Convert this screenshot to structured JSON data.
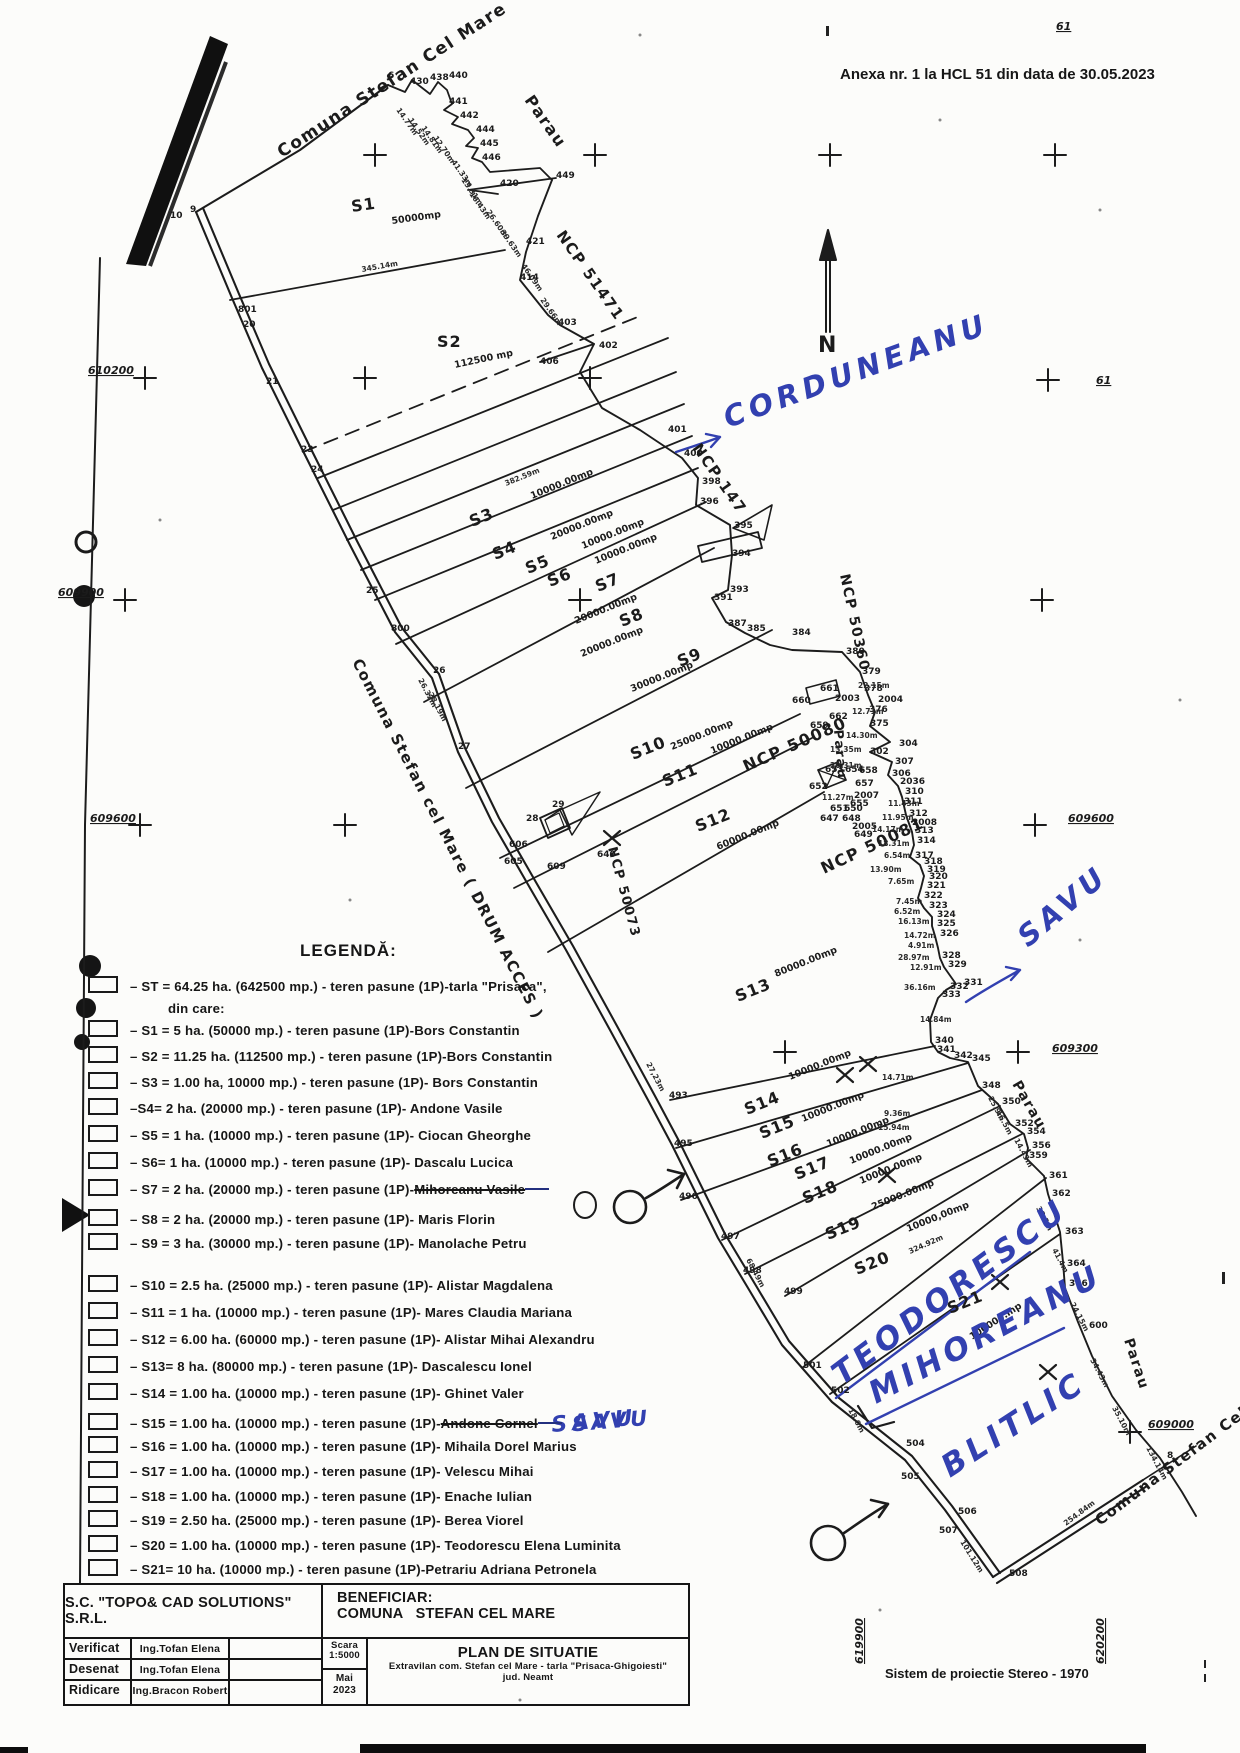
{
  "page": {
    "anexa": "Anexa nr. 1 la HCL 51 din data de 30.05.2023",
    "projection_note": "Sistem de proiectie Stereo - 1970"
  },
  "title_block": {
    "company": "S.C. \"TOPO& CAD SOLUTIONS\" S.R.L.",
    "beneficiar_label": "BENEFICIAR:",
    "beneficiar": "COMUNA   STEFAN CEL MARE",
    "rows": [
      {
        "role": "Verificat",
        "name": "Ing.Tofan Elena"
      },
      {
        "role": "Desenat",
        "name": "Ing.Tofan Elena"
      },
      {
        "role": "Ridicare",
        "name": "Ing.Bracon Robert"
      }
    ],
    "scara_label": "Scara",
    "scara": "1:5000",
    "month": "Mai",
    "year": "2023",
    "plan_title": "PLAN DE SITUATIE",
    "plan_subtitle": "Extravilan com. Stefan cel Mare - tarla \"Prisaca-Ghigoiesti\"",
    "plan_sub2": "jud. Neamt"
  },
  "legend": {
    "title": "LEGENDĂ:",
    "items": [
      {
        "text": "– ST = 64.25 ha. (642500 mp.) - teren pasune (1P)-tarla \"Prisaca\","
      },
      {
        "text": "din care:",
        "cont": true
      },
      {
        "text": "– S1 = 5 ha. (50000 mp.) - teren pasune (1P)-Bors Constantin"
      },
      {
        "text": "– S2 = 11.25 ha. (112500 mp.) - teren pasune (1P)-Bors Constantin"
      },
      {
        "text": "– S3 = 1.00 ha, 10000 mp.) - teren pasune (1P)- Bors Constantin"
      },
      {
        "text": "–S4= 2 ha. (20000 mp.) - teren pasune (1P)- Andone Vasile"
      },
      {
        "text": "– S5 = 1 ha. (10000 mp.) - teren pasune (1P)- Ciocan Gheorghe"
      },
      {
        "text": "– S6= 1 ha. (10000 mp.) - teren pasune (1P)- Dascalu Lucica"
      },
      {
        "text": "– S7 = 2 ha. (20000 mp.) - teren pasune (1P)-",
        "struck": "Mihoreanu Vasile"
      },
      {
        "text": "– S8 = 2 ha. (20000 mp.) - teren pasune (1P)- Maris Florin"
      },
      {
        "text": "– S9 = 3 ha. (30000 mp.) - teren pasune (1P)- Manolache Petru"
      },
      {
        "text": "– S10 = 2.5 ha. (25000 mp.) - teren pasune (1P)- Alistar Magdalena"
      },
      {
        "text": "– S11 = 1 ha. (10000 mp.) - teren pasune (1P)- Mares Claudia Mariana"
      },
      {
        "text": "– S12 = 6.00 ha. (60000 mp.) - teren pasune (1P)- Alistar Mihai Alexandru"
      },
      {
        "text": "– S13= 8 ha. (80000 mp.) - teren pasune (1P)- Dascalescu Ionel"
      },
      {
        "text": "– S14 = 1.00 ha. (10000 mp.) - teren pasune (1P)- Ghinet Valer"
      },
      {
        "text": "– S15 = 1.00 ha. (10000 mp.) - teren pasune (1P)-",
        "struck": "Andone Cornel",
        "note": "SAVU"
      },
      {
        "text": "– S16 = 1.00 ha. (10000 mp.) - teren pasune (1P)- Mihaila Dorel Marius"
      },
      {
        "text": "– S17 = 1.00 ha. (10000 mp.) - teren pasune (1P)- Velescu Mihai"
      },
      {
        "text": "– S18 = 1.00 ha. (10000 mp.) - teren pasune (1P)- Enache Iulian"
      },
      {
        "text": "– S19 = 2.50 ha. (25000 mp.) - teren pasune (1P)- Berea Viorel"
      },
      {
        "text": "– S20 = 1.00 ha. (10000 mp.) - teren pasune (1P)- Teodorescu Elena Luminita"
      },
      {
        "text": "– S21= 10 ha. (10000 mp.) - teren pasune (1P)-Petrariu Adriana Petronela"
      }
    ]
  },
  "map": {
    "labels": {
      "comuna_top": "Comuna Stefan Cel Mare",
      "parau_top": "Parau",
      "ncp51471": "NCP 51471",
      "ncp147": "NCP 147",
      "ncp50360": "NCP 50360",
      "ncp50080": "NCP 50080",
      "ncp50081": "NCP 50081",
      "ncp50073": "NCP 50073",
      "parau_mid": "Parau",
      "parau_s14": "Parau",
      "parau_low": "Parau",
      "drum": "Comuna Stefan cel Mare ( DRUM ACCES )",
      "comuna_bottom": "Comuna Stefan Cel Mare",
      "north": "N"
    },
    "parcels": [
      {
        "n": "S1",
        "x": 352,
        "y": 212,
        "r": -8,
        "a": "50000mp",
        "ax": 392,
        "ay": 224,
        "ar": -8
      },
      {
        "n": "S2",
        "x": 437,
        "y": 347,
        "r": 0,
        "a": "112500 mp",
        "ax": 455,
        "ay": 368,
        "ar": -12
      },
      {
        "n": "S3",
        "x": 472,
        "y": 527,
        "r": -22,
        "a": "10000.00mp",
        "ax": 532,
        "ay": 499
      },
      {
        "n": "S4",
        "x": 495,
        "y": 560,
        "r": -22,
        "a": "20000.00mp",
        "ax": 552,
        "ay": 540
      },
      {
        "n": "S5",
        "x": 528,
        "y": 574,
        "r": -22,
        "a": "10000.00mp",
        "ax": 583,
        "ay": 549
      },
      {
        "n": "S6",
        "x": 550,
        "y": 587,
        "r": -22,
        "a": "10000.00mp",
        "ax": 596,
        "ay": 564
      },
      {
        "n": "S7",
        "x": 598,
        "y": 592,
        "r": -22,
        "a": "20000.00mp",
        "ax": 576,
        "ay": 624
      },
      {
        "n": "S8",
        "x": 622,
        "y": 627,
        "r": -22,
        "a": "20000.00mp",
        "ax": 582,
        "ay": 657
      },
      {
        "n": "S9",
        "x": 680,
        "y": 667,
        "r": -22,
        "a": "30000.00mp",
        "ax": 632,
        "ay": 692
      },
      {
        "n": "S10",
        "x": 633,
        "y": 760,
        "r": -22,
        "a": "25000.00mp",
        "ax": 672,
        "ay": 750
      },
      {
        "n": "S11",
        "x": 665,
        "y": 787,
        "r": -22,
        "a": "10000.00mp",
        "ax": 712,
        "ay": 754
      },
      {
        "n": "S12",
        "x": 698,
        "y": 832,
        "r": -22,
        "a": "60000.00mp",
        "ax": 718,
        "ay": 850
      },
      {
        "n": "S13",
        "x": 738,
        "y": 1002,
        "r": -22,
        "a": "80000.00mp",
        "ax": 776,
        "ay": 977
      },
      {
        "n": "S14",
        "x": 747,
        "y": 1115,
        "r": -22,
        "a": "10000.00mp",
        "ax": 790,
        "ay": 1080
      },
      {
        "n": "S15",
        "x": 762,
        "y": 1139,
        "r": -22,
        "a": "10000.00mp",
        "ax": 803,
        "ay": 1122
      },
      {
        "n": "S16",
        "x": 770,
        "y": 1167,
        "r": -22,
        "a": "10000.00mp",
        "ax": 828,
        "ay": 1147
      },
      {
        "n": "S17",
        "x": 797,
        "y": 1180,
        "r": -22,
        "a": "10000.00mp",
        "ax": 851,
        "ay": 1164
      },
      {
        "n": "S18",
        "x": 805,
        "y": 1204,
        "r": -22,
        "a": "10000.00mp",
        "ax": 861,
        "ay": 1184
      },
      {
        "n": "S19",
        "x": 828,
        "y": 1240,
        "r": -22,
        "a": "25000.00mp",
        "ax": 873,
        "ay": 1210
      },
      {
        "n": "S20",
        "x": 857,
        "y": 1275,
        "r": -22,
        "a": "10000,00mp",
        "ax": 908,
        "ay": 1232
      },
      {
        "n": "S21",
        "x": 950,
        "y": 1314,
        "r": -22,
        "a": "100000.mp",
        "ax": 972,
        "ay": 1340,
        "ar": -33
      }
    ],
    "point_labels": [
      [
        "6",
        388,
        78
      ],
      [
        "430",
        410,
        84
      ],
      [
        "438",
        430,
        80
      ],
      [
        "440",
        449,
        78
      ],
      [
        "441",
        449,
        104
      ],
      [
        "442",
        460,
        118
      ],
      [
        "444",
        476,
        132
      ],
      [
        "445",
        480,
        146
      ],
      [
        "446",
        482,
        160
      ],
      [
        "420",
        500,
        186
      ],
      [
        "449",
        556,
        178
      ],
      [
        "421",
        526,
        244
      ],
      [
        "414",
        520,
        280
      ],
      [
        "403",
        558,
        325
      ],
      [
        "402",
        599,
        348
      ],
      [
        "406",
        540,
        364
      ],
      [
        "401",
        668,
        432
      ],
      [
        "400",
        684,
        456
      ],
      [
        "398",
        702,
        484
      ],
      [
        "396",
        700,
        504
      ],
      [
        "395",
        734,
        528
      ],
      [
        "394",
        732,
        556
      ],
      [
        "393",
        730,
        592
      ],
      [
        "391",
        714,
        600
      ],
      [
        "387",
        728,
        626
      ],
      [
        "385",
        747,
        631
      ],
      [
        "384",
        792,
        635
      ],
      [
        "380",
        846,
        654
      ],
      [
        "379",
        862,
        674
      ],
      [
        "378",
        864,
        691
      ],
      [
        "2004",
        878,
        702
      ],
      [
        "376",
        869,
        712
      ],
      [
        "375",
        870,
        726
      ],
      [
        "304",
        899,
        746
      ],
      [
        "302",
        870,
        754
      ],
      [
        "307",
        895,
        764
      ],
      [
        "306",
        892,
        776
      ],
      [
        "661",
        820,
        691
      ],
      [
        "660",
        792,
        703
      ],
      [
        "2003",
        835,
        701
      ],
      [
        "662",
        829,
        719
      ],
      [
        "659",
        810,
        728
      ],
      [
        "653",
        825,
        772
      ],
      [
        "654",
        845,
        772
      ],
      [
        "658",
        859,
        773
      ],
      [
        "652",
        809,
        789
      ],
      [
        "657",
        855,
        786
      ],
      [
        "2007",
        854,
        798
      ],
      [
        "655",
        850,
        806
      ],
      [
        "651",
        830,
        811
      ],
      [
        "650",
        844,
        811
      ],
      [
        "647",
        820,
        821
      ],
      [
        "648",
        842,
        821
      ],
      [
        "2005",
        852,
        829
      ],
      [
        "649",
        854,
        837
      ],
      [
        "2036",
        900,
        784
      ],
      [
        "310",
        905,
        794
      ],
      [
        "311",
        904,
        804
      ],
      [
        "312",
        909,
        816
      ],
      [
        "2008",
        912,
        825
      ],
      [
        "313",
        915,
        833
      ],
      [
        "314",
        917,
        843
      ],
      [
        "317",
        915,
        858
      ],
      [
        "318",
        924,
        864
      ],
      [
        "319",
        927,
        872
      ],
      [
        "320",
        929,
        879
      ],
      [
        "321",
        927,
        888
      ],
      [
        "322",
        924,
        898
      ],
      [
        "323",
        929,
        908
      ],
      [
        "324",
        937,
        917
      ],
      [
        "325",
        937,
        926
      ],
      [
        "326",
        940,
        936
      ],
      [
        "328",
        942,
        958
      ],
      [
        "329",
        948,
        967
      ],
      [
        "331",
        964,
        985
      ],
      [
        "332",
        950,
        989
      ],
      [
        "333",
        942,
        997
      ],
      [
        "340",
        935,
        1043
      ],
      [
        "341",
        937,
        1052
      ],
      [
        "342",
        954,
        1058
      ],
      [
        "345",
        972,
        1061
      ],
      [
        "348",
        982,
        1088
      ],
      [
        "350",
        1002,
        1104
      ],
      [
        "352",
        1015,
        1126
      ],
      [
        "354",
        1027,
        1134
      ],
      [
        "356",
        1032,
        1148
      ],
      [
        "359",
        1029,
        1158
      ],
      [
        "361",
        1049,
        1178
      ],
      [
        "362",
        1052,
        1196
      ],
      [
        "363",
        1065,
        1234
      ],
      [
        "364",
        1067,
        1266
      ],
      [
        "366",
        1069,
        1286
      ],
      [
        "600",
        1089,
        1328
      ],
      [
        "8",
        1167,
        1458
      ],
      [
        "10",
        170,
        218
      ],
      [
        "9",
        190,
        212
      ],
      [
        "801",
        238,
        312
      ],
      [
        "20",
        243,
        327
      ],
      [
        "21",
        266,
        384
      ],
      [
        "23",
        301,
        452
      ],
      [
        "24",
        311,
        472
      ],
      [
        "25",
        366,
        593
      ],
      [
        "800",
        391,
        631
      ],
      [
        "26",
        433,
        673
      ],
      [
        "27",
        458,
        749
      ],
      [
        "28",
        526,
        821
      ],
      [
        "29",
        552,
        807
      ],
      [
        "606",
        509,
        847
      ],
      [
        "605",
        504,
        864
      ],
      [
        "609",
        547,
        869
      ],
      [
        "640",
        597,
        857
      ],
      [
        "493",
        669,
        1098
      ],
      [
        "495",
        674,
        1146
      ],
      [
        "496",
        679,
        1199
      ],
      [
        "497",
        721,
        1239
      ],
      [
        "498",
        743,
        1273
      ],
      [
        "499",
        784,
        1294
      ],
      [
        "501",
        803,
        1368
      ],
      [
        "502",
        831,
        1393
      ],
      [
        "504",
        906,
        1446
      ],
      [
        "505",
        901,
        1479
      ],
      [
        "506",
        958,
        1514
      ],
      [
        "507",
        939,
        1533
      ],
      [
        "508",
        1009,
        1576
      ]
    ],
    "distance_labels": [
      [
        "14.77m",
        396,
        110,
        55
      ],
      [
        "14.52m",
        408,
        120,
        55
      ],
      [
        "14.81m",
        421,
        128,
        55
      ],
      [
        "12.70m",
        433,
        138,
        55
      ],
      [
        "41.33m",
        451,
        162,
        55
      ],
      [
        "13.31m",
        461,
        180,
        55
      ],
      [
        "16.43m",
        469,
        194,
        55
      ],
      [
        "26.60m",
        486,
        212,
        55
      ],
      [
        "39.63m",
        500,
        232,
        55
      ],
      [
        "46.09m",
        521,
        266,
        55
      ],
      [
        "29.66m",
        540,
        300,
        55
      ],
      [
        "345.14m",
        362,
        272,
        -10
      ],
      [
        "382.59m",
        506,
        486,
        -22
      ],
      [
        "26.32m",
        418,
        680,
        62
      ],
      [
        "28.19m",
        428,
        694,
        62
      ],
      [
        "27,23m",
        646,
        1064,
        62
      ],
      [
        "68,49m",
        746,
        1260,
        62
      ],
      [
        "324.92m",
        910,
        1254,
        -24
      ],
      [
        "101.12m",
        960,
        1542,
        58
      ],
      [
        "254.84m",
        1066,
        1526,
        -37
      ],
      [
        "22.15m",
        858,
        688,
        0
      ],
      [
        "12.71m",
        852,
        714,
        0
      ],
      [
        "14.30m",
        846,
        738,
        0
      ],
      [
        "13.35m",
        830,
        752,
        0
      ],
      [
        "20.31m",
        830,
        768,
        0
      ],
      [
        "11.27m",
        822,
        800,
        0
      ],
      [
        "11.43m",
        888,
        806,
        0
      ],
      [
        "11.95m",
        882,
        820,
        0
      ],
      [
        "14.17m",
        872,
        832,
        0
      ],
      [
        "18.31m",
        878,
        846,
        0
      ],
      [
        "6.54m",
        884,
        858,
        0
      ],
      [
        "13.90m",
        870,
        872,
        0
      ],
      [
        "7.65m",
        888,
        884,
        0
      ],
      [
        "7.45m",
        896,
        904,
        0
      ],
      [
        "6.52m",
        894,
        914,
        0
      ],
      [
        "16.13m",
        898,
        924,
        0
      ],
      [
        "14.72m",
        904,
        938,
        0
      ],
      [
        "4.91m",
        908,
        948,
        0
      ],
      [
        "28.97m",
        898,
        960,
        0
      ],
      [
        "12.91m",
        910,
        970,
        0
      ],
      [
        "36.16m",
        904,
        990,
        0
      ],
      [
        "14.84m",
        920,
        1022,
        0
      ],
      [
        "14.71m",
        882,
        1080,
        0
      ],
      [
        "9.36m",
        884,
        1116,
        0
      ],
      [
        "15.94m",
        878,
        1130,
        0
      ],
      [
        "25.9m",
        988,
        1098,
        62
      ],
      [
        "16.5m",
        996,
        1112,
        62
      ],
      [
        "14.43m",
        1014,
        1140,
        62
      ],
      [
        "38.3m",
        1036,
        1208,
        62
      ],
      [
        "41.4m",
        1052,
        1250,
        62
      ],
      [
        "24.15m",
        1070,
        1304,
        62
      ],
      [
        "34.43m",
        1090,
        1360,
        62
      ],
      [
        "35.10m",
        1112,
        1408,
        62
      ],
      [
        "134.14m",
        1146,
        1448,
        62
      ],
      [
        "18.0m",
        848,
        1410,
        62
      ]
    ],
    "coords": [
      [
        "610200",
        88,
        374,
        0
      ],
      [
        "609900",
        58,
        596,
        0
      ],
      [
        "609600",
        90,
        822,
        0
      ],
      [
        "609600",
        1068,
        822,
        0
      ],
      [
        "609300",
        1052,
        1052,
        0
      ],
      [
        "609000",
        1148,
        1428,
        0
      ],
      [
        "619900",
        863,
        1664,
        -90
      ],
      [
        "620200",
        1104,
        1664,
        -90
      ],
      [
        "61",
        1096,
        384,
        0
      ],
      [
        "61",
        1056,
        30,
        0
      ]
    ],
    "annotations_blue": [
      {
        "t": "CORDUNEANU",
        "x": 728,
        "y": 428,
        "r": -20,
        "s": 29
      },
      {
        "t": "SAVU",
        "x": 1028,
        "y": 948,
        "r": -40,
        "s": 29
      },
      {
        "t": "TEODORESCU",
        "x": 842,
        "y": 1386,
        "r": -37,
        "s": 31
      },
      {
        "t": "MIHOREANU",
        "x": 876,
        "y": 1404,
        "r": -28,
        "s": 31
      },
      {
        "t": "BLITLIC",
        "x": 950,
        "y": 1478,
        "r": -33,
        "s": 31
      },
      {
        "t": "SAVU",
        "x": 552,
        "y": 1432,
        "r": -5,
        "s": 22
      }
    ]
  },
  "colors": {
    "ink": "#1c1c1c",
    "pen_blue": "#3240b0"
  }
}
